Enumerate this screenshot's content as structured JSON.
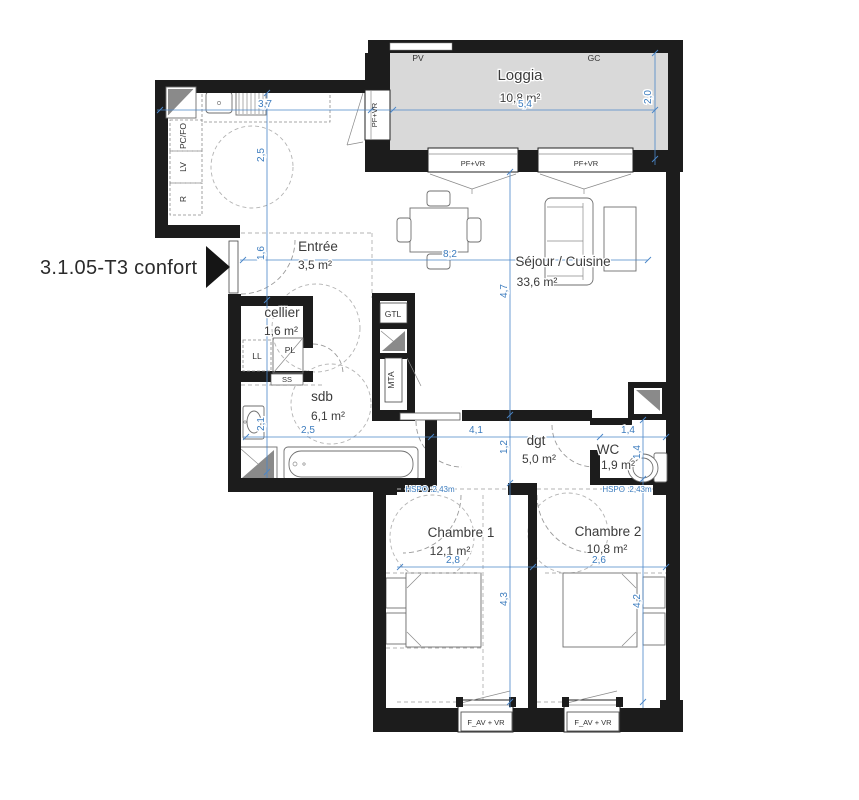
{
  "title": "3.1.05-T3 confort",
  "rooms": {
    "loggia": {
      "name": "Loggia",
      "area": "10,8 m²"
    },
    "entree": {
      "name": "Entrée",
      "area": "3,5 m²"
    },
    "sejour": {
      "name": "Séjour / Cuisine",
      "area": "33,6 m²"
    },
    "cellier": {
      "name": "cellier",
      "area": "1,6 m²"
    },
    "sdb": {
      "name": "sdb",
      "area": "6,1 m²"
    },
    "dgt": {
      "name": "dgt",
      "area": "5,0 m²"
    },
    "wc": {
      "name": "WC",
      "area": "1,9 m²"
    },
    "chambre1": {
      "name": "Chambre 1",
      "area": "12,1 m²"
    },
    "chambre2": {
      "name": "Chambre 2",
      "area": "10,8 m²"
    }
  },
  "labels": {
    "pv": "PV",
    "gc": "GC",
    "pf_vr": "PF+VR",
    "f_av_vr": "F_AV + VR",
    "gtl": "GTL",
    "mta": "MTA",
    "ll": "LL",
    "pl": "PL",
    "ss": "SS",
    "pcfo": "PC/FO",
    "lv": "LV",
    "r": "R",
    "hspo": "HSPO :2,43m"
  },
  "dimensions": {
    "kitchen_width": "3,7",
    "loggia_width": "5,4",
    "loggia_depth": "2,0",
    "kitchen_depth": "2,5",
    "entree_depth": "1,6",
    "sejour_width": "8,2",
    "sejour_depth": "4,7",
    "sdb_width": "2,5",
    "sdb_depth": "2,1",
    "dgt_width": "4,1",
    "dgt_depth": "1,2",
    "wc_width": "1,4",
    "wc_depth": "1,4",
    "chambre1_width": "2,8",
    "chambre1_depth": "4,3",
    "chambre2_width": "2,6",
    "chambre2_depth": "4,2"
  },
  "colors": {
    "wall": "#1c1c1c",
    "loggia_fill": "#d9d9d9",
    "dimension_blue": "#4a86c8",
    "duct_gray": "#8a8a8a",
    "furniture_gray": "#6f6f6f",
    "text_dark": "#3b3b3b"
  }
}
